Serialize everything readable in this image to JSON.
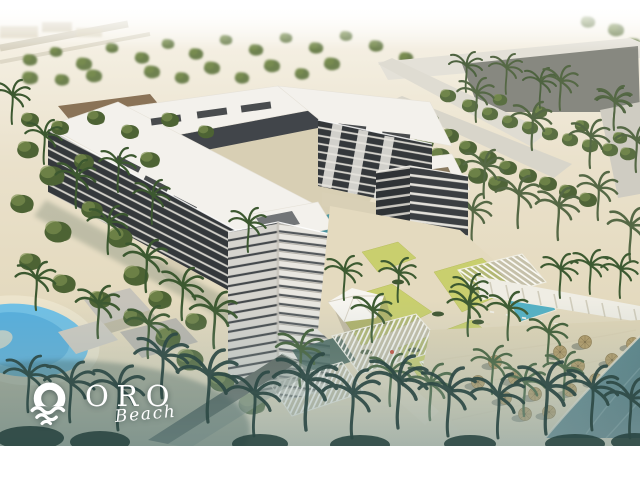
{
  "image": {
    "alt": "Aerial architectural rendering of a U-shaped beachfront apartment resort with pools, lawns, pergolas, palm trees and a sandy beach with thatched umbrellas"
  },
  "logo": {
    "brand": "ORO",
    "sub": "Beach",
    "icon": "sun-over-waves-icon"
  },
  "colors": {
    "frame": "#ffffff",
    "sky_haze": "#f2ecdd",
    "sand": "#e4dabf",
    "beach_sand": "#e0d5b6",
    "roof": "#f3f1ec",
    "facade_dark": "#34383b",
    "facade_light": "#e9e7e2",
    "lawn": "#c9cf6e",
    "lagoon": "#6fc0e6",
    "canal": "#41808a",
    "sea": "#3f6d75",
    "haze": "#8fa9ab",
    "thatch": "#b1975f",
    "tree": "#4d6334",
    "palm": "#3c5830",
    "palm_distant": "#556845",
    "palm_silhouette": "#2e4a46",
    "logo": "#ffffff"
  }
}
